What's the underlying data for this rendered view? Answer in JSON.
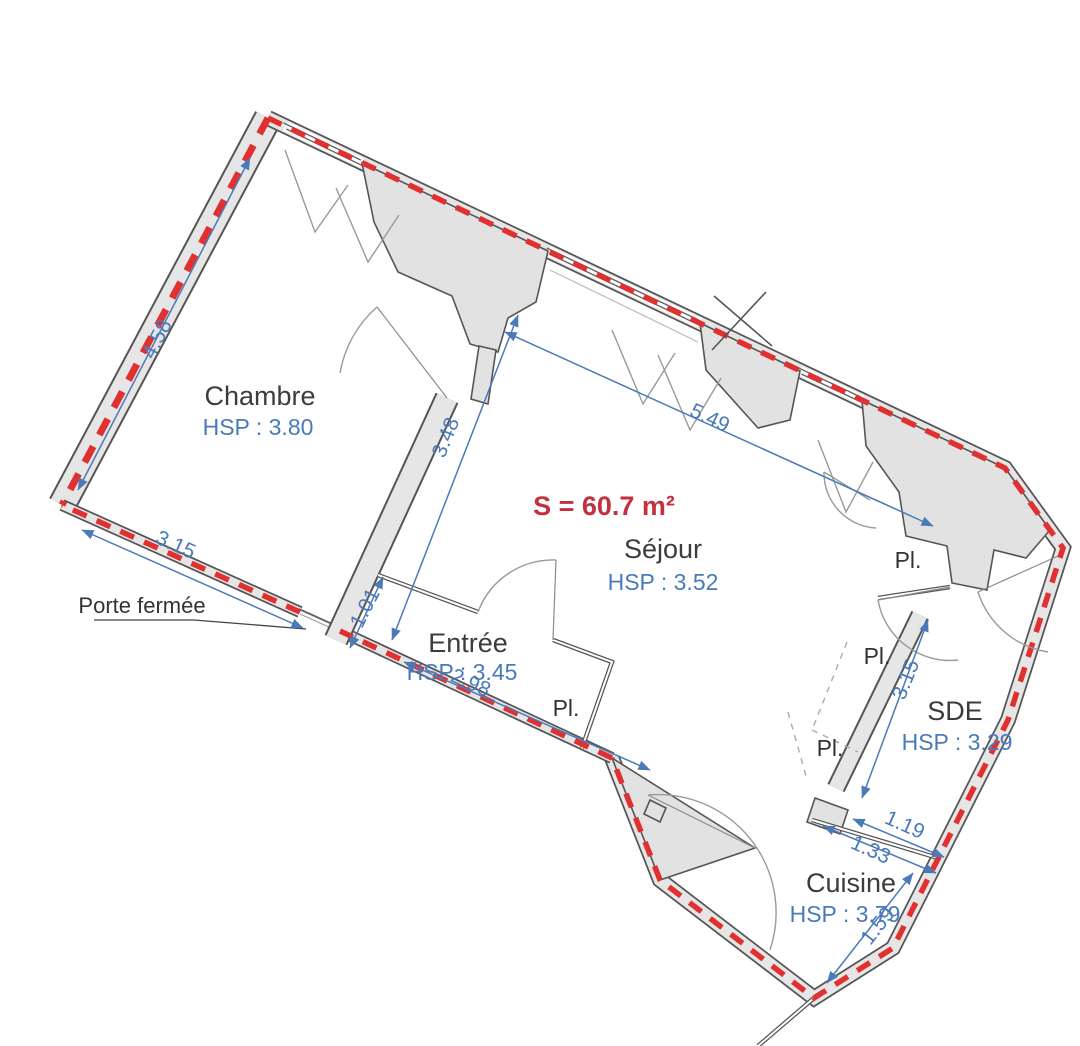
{
  "plan": {
    "title": "Floor plan",
    "area_label": "S = 60.7 m²",
    "rooms": [
      {
        "name": "Chambre",
        "hsp": "HSP : 3.80"
      },
      {
        "name": "Séjour",
        "hsp": "HSP : 3.52"
      },
      {
        "name": "Entrée",
        "hsp": "HSP : 3.45"
      },
      {
        "name": "SDE",
        "hsp": "HSP : 3.29"
      },
      {
        "name": "Cuisine",
        "hsp": "HSP : 3.79"
      }
    ],
    "closets": [
      "Pl.",
      "Pl.",
      "Pl.",
      "Pl."
    ],
    "closed_door_label": "Porte fermée",
    "dimensions": [
      "4.58",
      "3.15",
      "3.48",
      "1.01",
      "2.98",
      "5.49",
      "3.15",
      "1.19",
      "1.33",
      "1.59"
    ],
    "colors": {
      "perimeter_red": "#e03030",
      "dimension_blue": "#4a7ab8",
      "area_red": "#c2323e",
      "wall_fill": "#e6e6e6",
      "wall_edge": "#555555",
      "text_dark": "#3c3c3c"
    }
  }
}
